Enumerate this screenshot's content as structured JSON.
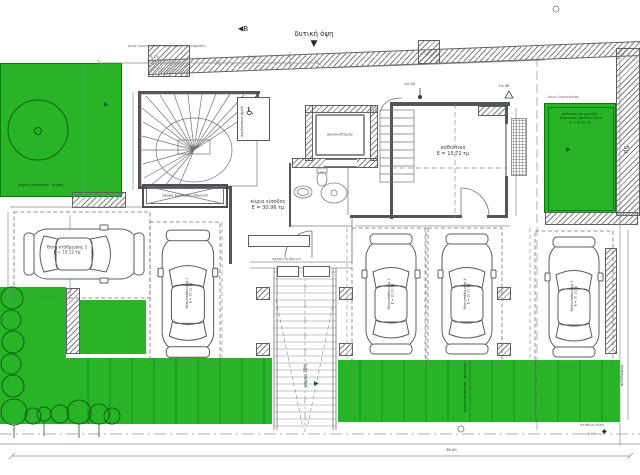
{
  "plan": {
    "west_elevation_label": "δυτική όψη",
    "section_marker": "B",
    "top_boundary_note": "όριο ιδιοκτησίας - υφιστάμενη περίφραξη",
    "setback_label": "5μ",
    "sidewalk_label": "πεζοδρόμιο",
    "street_level_note": "στάθμη οδού",
    "bottom_total_dim": "36.40",
    "dim_top_1": "4.70",
    "dim_top_2": "2.10",
    "dim_top_3": "4.73",
    "level_zero": "±0.00",
    "level_038": "+0.38"
  },
  "rooms": {
    "living_name": "καθιστικό",
    "living_area": "Ε = 15.72 τμ",
    "entrance_name": "κύρια είσοδος",
    "entrance_area": "Ε = 30.96 τμ",
    "elevator_label": "ανελκυστήρας",
    "lift_label": "αναβατόριο ΑμεΑ",
    "grating_label": "σχάρα φωτισμού υπογείου",
    "drain_label": "σχάρα ομβρίων"
  },
  "parking": {
    "ramp_label": "ράμπα 18%",
    "spaces": [
      {
        "name": "Θέση στάθμευσης 1",
        "area": "Ε = 10.12 τμ"
      },
      {
        "name": "Θέση στάθμευσης 2",
        "area": "Ε = 10.12 τμ"
      },
      {
        "name": "Θέση στάθμευσης 3",
        "area": "Ε = 10.12 τμ"
      },
      {
        "name": "Θέση στάθμευσης 4",
        "area": "Ε = 10.12 τμ"
      },
      {
        "name": "Θέση στάθμευσης 5",
        "area": "Ε = 10.12 τμ"
      }
    ]
  },
  "green": {
    "garden_note": "χώρος πρασίνου - κήπος",
    "right_boundary_note": "όριο ιδιοκτησίας",
    "right_line1": "φύτευση με χαμηλή",
    "right_line2": "βλάστηση βάθους 40εκ",
    "right_line3": "Ε = 8.50 τμ",
    "band_note": "χώρος πρασίνου - φύτευση"
  },
  "icons": {
    "wheelchair": "♿",
    "triangle_down": "▼",
    "arrow": "▶",
    "diamond": "◆"
  },
  "colors": {
    "green": "#27b527",
    "hatch_line": "#6a6e71",
    "wall": "#52565a"
  }
}
